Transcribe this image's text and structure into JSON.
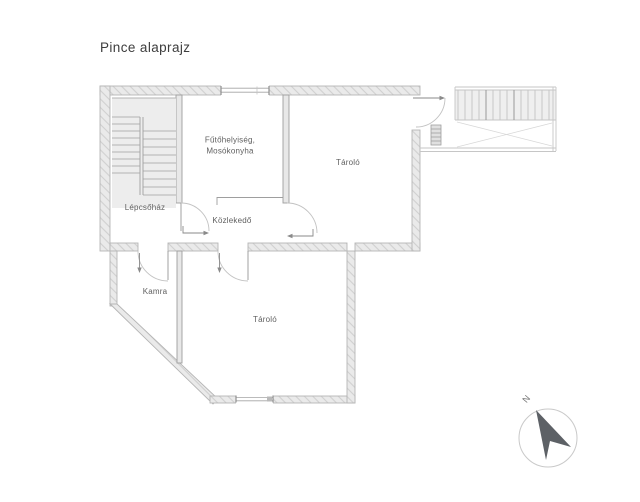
{
  "title": "Pince alaprajz",
  "rooms": {
    "staircase": "Lépcsőház",
    "heating_line1": "Fűtőhelyiség,",
    "heating_line2": "Mosókonyha",
    "storage_top": "Tároló",
    "corridor": "Közlekedő",
    "pantry": "Kamra",
    "storage_bottom": "Tároló"
  },
  "compass": {
    "north": "N"
  },
  "colors": {
    "background": "#ffffff",
    "wall_fill": "#eaeaea",
    "wall_hatch": "#d0d0d0",
    "wall_outline": "#b5b5b5",
    "thin_line": "#9e9e9e",
    "stair_line": "#b4b4b4",
    "label_text": "#5f5f5f",
    "title_text": "#3d3d3d",
    "north_arrow": "#5d6166"
  }
}
